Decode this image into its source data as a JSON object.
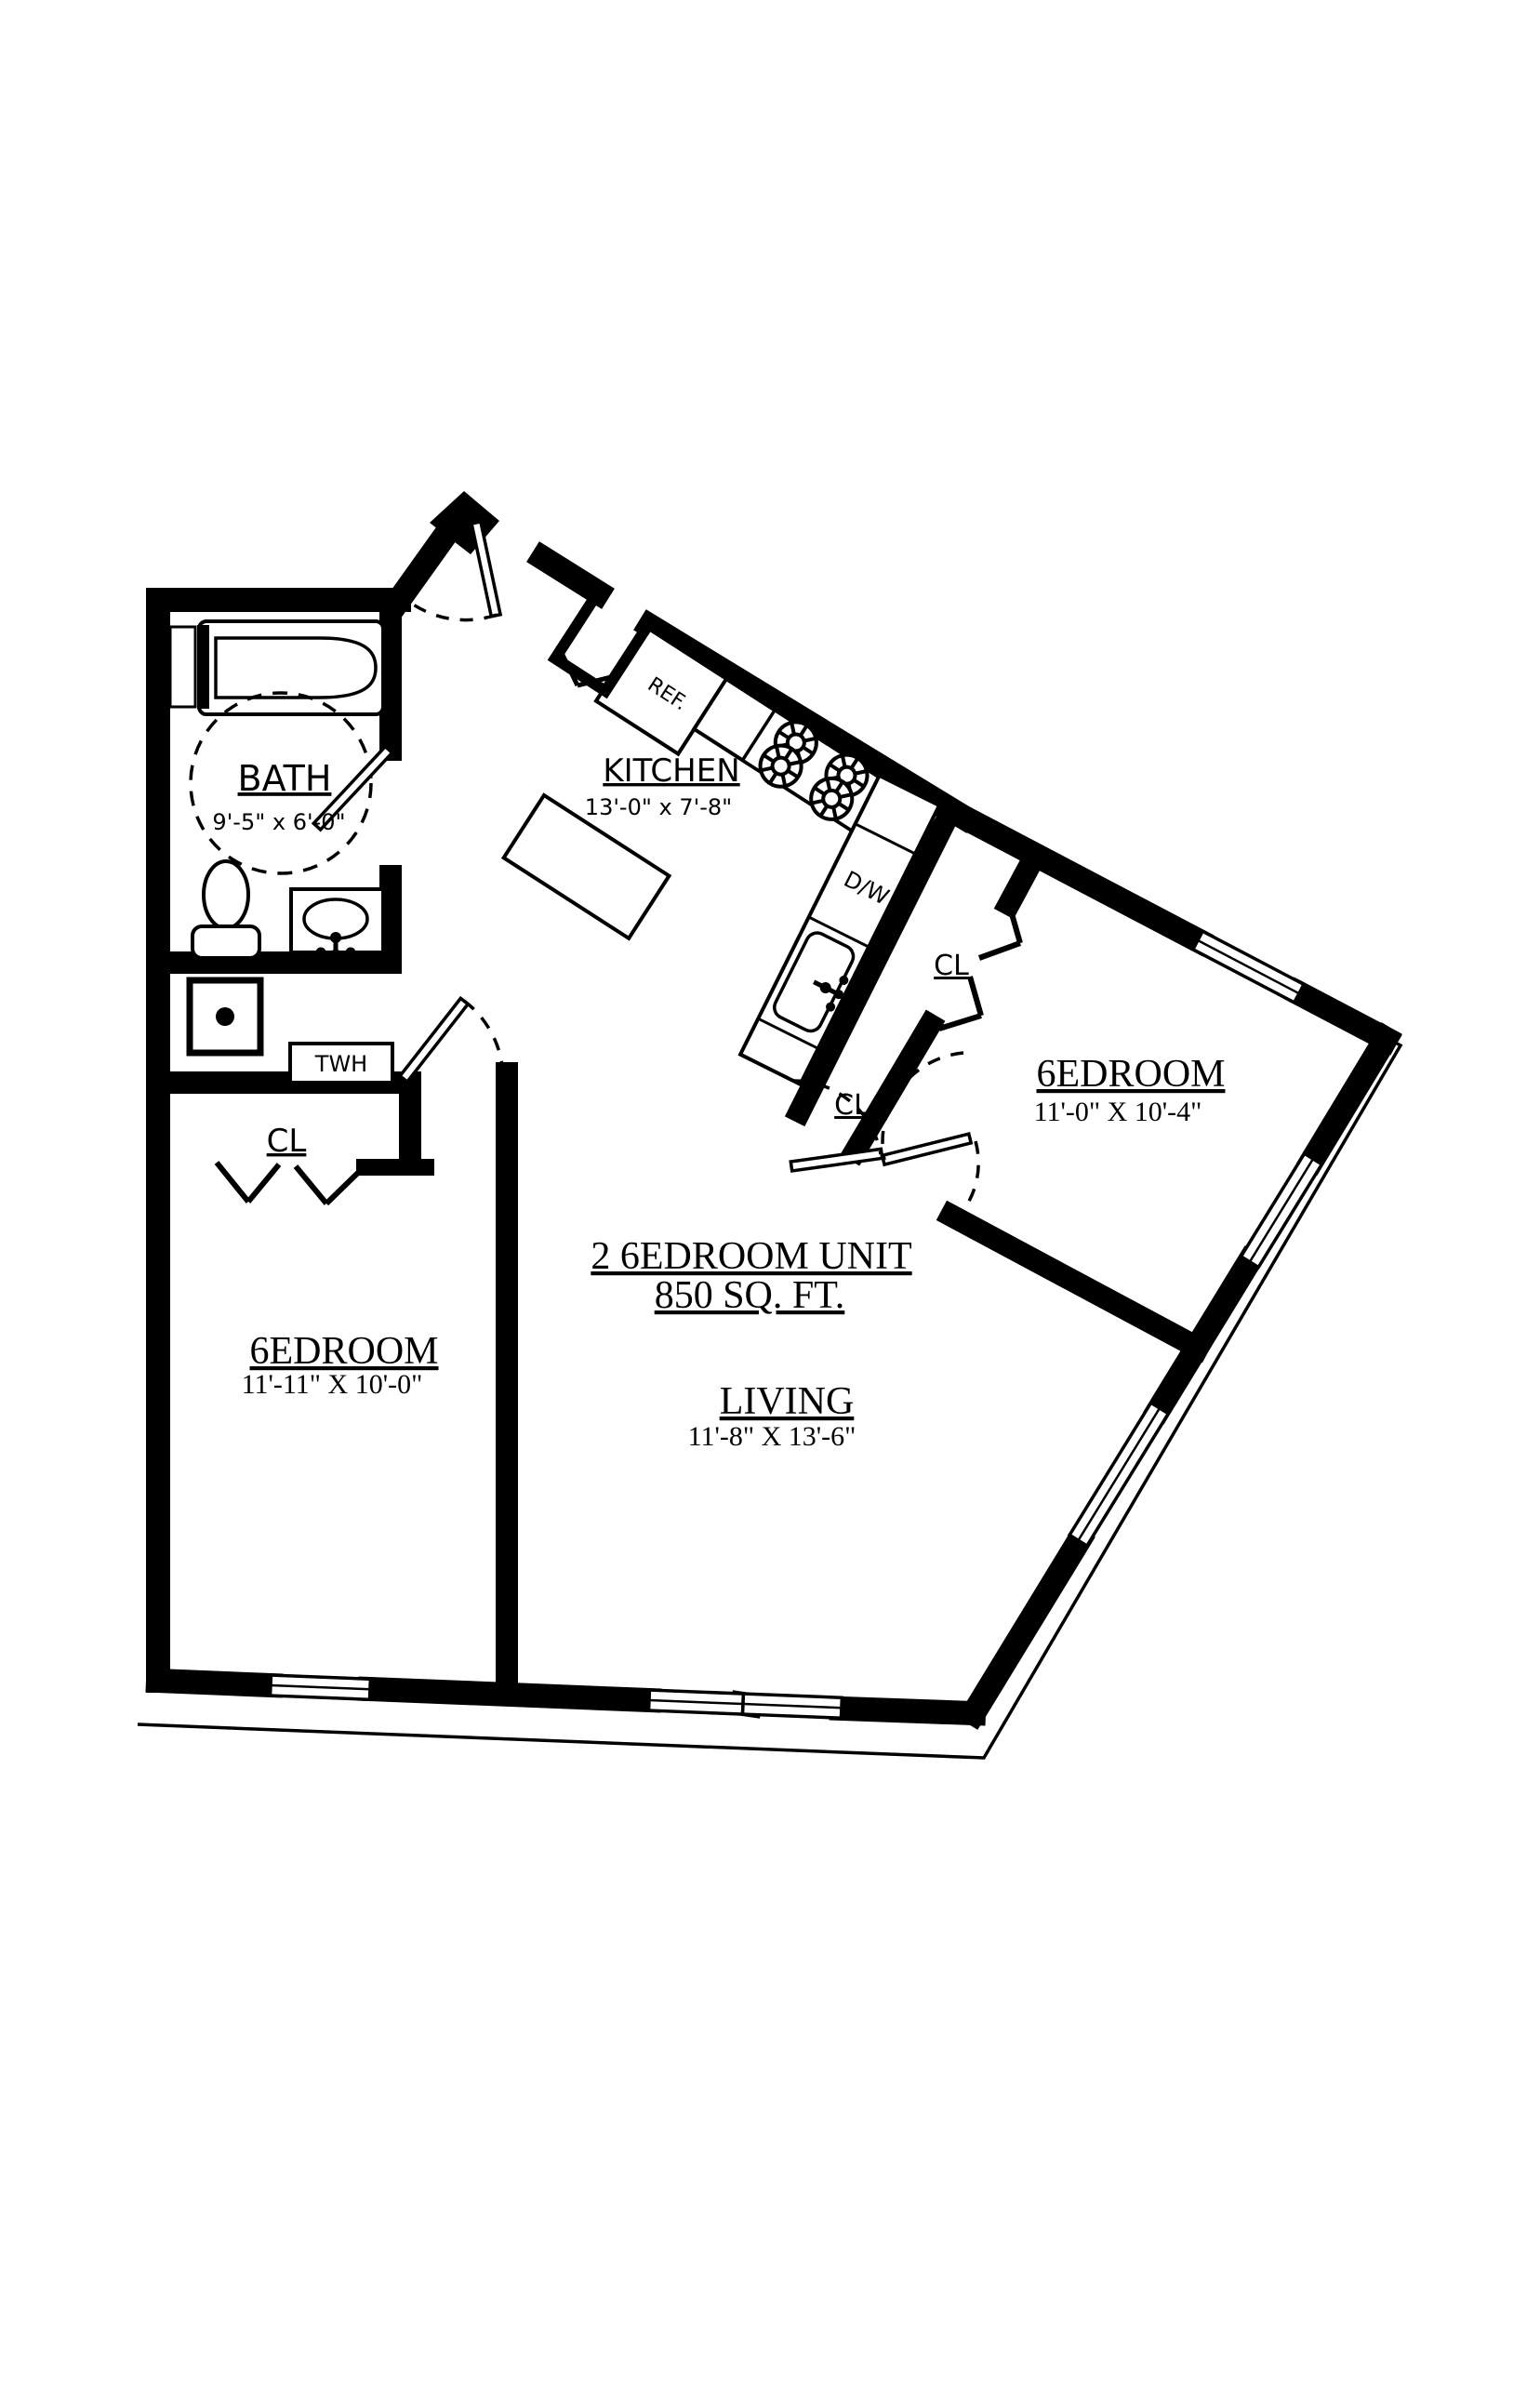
{
  "plan": {
    "unit": {
      "title": "2 6EDROOM UNIT",
      "area": "850 SQ. FT."
    },
    "rooms": {
      "bath": {
        "name": "BATH",
        "dims": "9'-5\" x 6'-0\""
      },
      "kitchen": {
        "name": "KITCHEN",
        "dims": "13'-0\" x 7'-8\""
      },
      "bedroom_right": {
        "name": "6EDROOM",
        "dims": "11'-0\" X 10'-4\""
      },
      "bedroom_left": {
        "name": "6EDROOM",
        "dims": "11'-11\" X 10'-0\""
      },
      "living": {
        "name": "LIVING",
        "dims": "11'-8\" X 13'-6\""
      }
    },
    "closets": {
      "left": "CL",
      "mid": "CL",
      "right": "CL"
    },
    "appliances": {
      "refrigerator": "REF.",
      "dishwasher": "D/W",
      "water_heater": "TWH"
    },
    "colors": {
      "wall": "#000000",
      "background": "#ffffff"
    }
  }
}
